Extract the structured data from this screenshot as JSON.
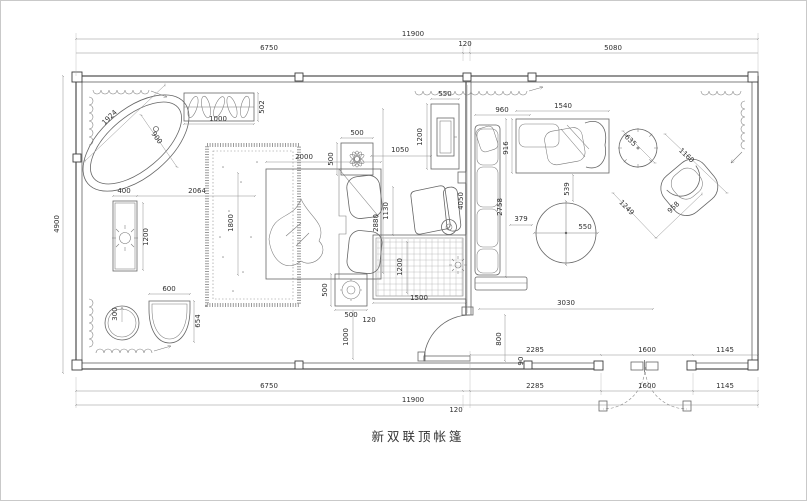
{
  "title": "新双联顶帐篷",
  "dims": {
    "top_overall": "11900",
    "top_seg1": "6750",
    "top_seg2": "120",
    "top_seg3": "5080",
    "left_height": "4900",
    "bot1_a": "2285",
    "bot1_b": "1600",
    "bot1_c": "1145",
    "bot2_a": "6750",
    "bot2_b": "2285",
    "bot2_c": "1600",
    "bot2_d": "1145",
    "bot3_a": "11900",
    "bot3_b": "120",
    "tub_len": "1924",
    "tub_w": "900",
    "rack_w": "1000",
    "rack_d": "502",
    "vanity_w": "400",
    "vanity_l": "1200",
    "vanity_gap": "2064",
    "stool_r": "300",
    "basin_w": "600",
    "basin_h": "654",
    "bed_w": "1800",
    "bed_l": "2000",
    "ns_top_w": "500",
    "ns_top_d": "500",
    "ns_bot_w": "500",
    "ns_bot_d": "500",
    "ns_gap": "1000",
    "ns_off": "120",
    "tv_gap": "1050",
    "tv_w": "550",
    "tv_l": "1200",
    "chair_w": "1130",
    "room_d": "2880",
    "mat_w": "1500",
    "mat_h": "1200",
    "door_w": "800",
    "wall_t": "90",
    "sofa1_w": "960",
    "partition_l": "4050",
    "sofa2_w": "1540",
    "sofa2_d": "916",
    "sofa2_gap": "539",
    "table1_d": "635",
    "chair2_w": "1160",
    "chair2_diag": "1249",
    "chair2_d": "958",
    "table2_gap": "379",
    "table2_d": "550",
    "living_d": "2758",
    "living_w": "3030"
  }
}
